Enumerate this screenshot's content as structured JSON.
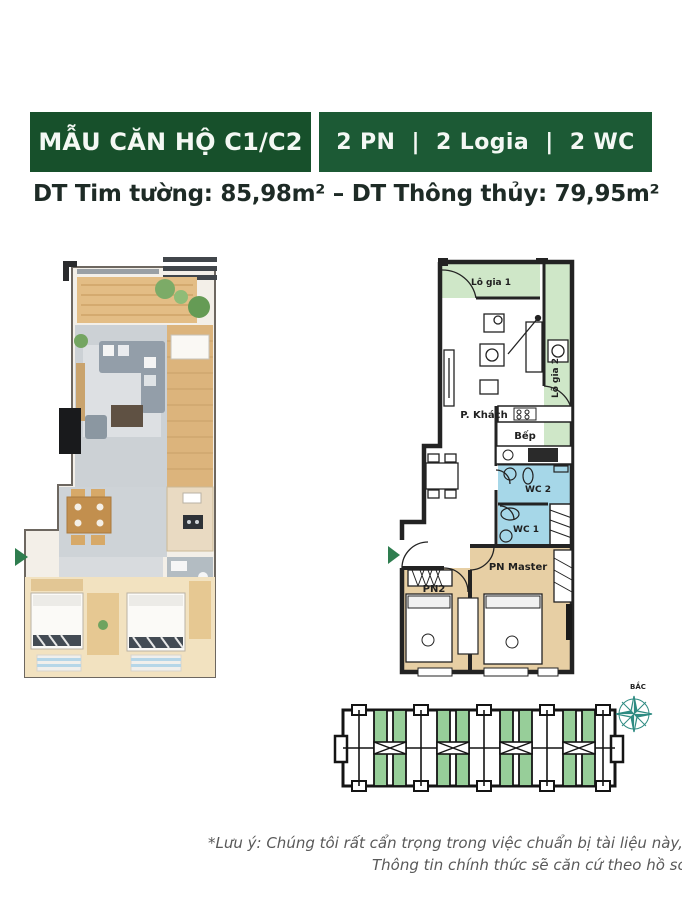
{
  "header": {
    "title": "MẪU CĂN HỘ C1/C2",
    "specs": "2 PN  |  2 Logia  |  2 WC",
    "title_bg": "#17502b",
    "specs_bg": "#1c5a35",
    "text_color": "#f4f8f4"
  },
  "area_line": {
    "label1": "DT Tim tường: ",
    "value1": "85,98m²",
    "separator": " – ",
    "label2": "DT Thông thủy: ",
    "value2": "79,95m²"
  },
  "plan_2d": {
    "labels": {
      "logia1": "Lô gia 1",
      "logia2": "Lô gia 2",
      "khach": "P. Khách",
      "bep": "Bếp",
      "wc2": "WC 2",
      "wc1": "WC 1",
      "pn2": "PN2",
      "master": "PN Master"
    },
    "colors": {
      "balcony": "#cfe7c8",
      "wc": "#a6d7e8",
      "bedroom": "#e7cfa4",
      "wall": "#232323",
      "entrance_arrow": "#2e7d4f"
    }
  },
  "site_plan": {
    "compass_label": "BẮC",
    "unit_highlight": "#97ce99",
    "compass_color": "#2e8b82"
  },
  "footer": {
    "note_line1": "*Lưu ý: Chúng tôi rất cẩn trọng trong việc chuẩn bị tài liệu này, Một số thông",
    "note_line2": "Thông tin chính thức sẽ căn cứ theo hồ sơ pháp lý"
  }
}
